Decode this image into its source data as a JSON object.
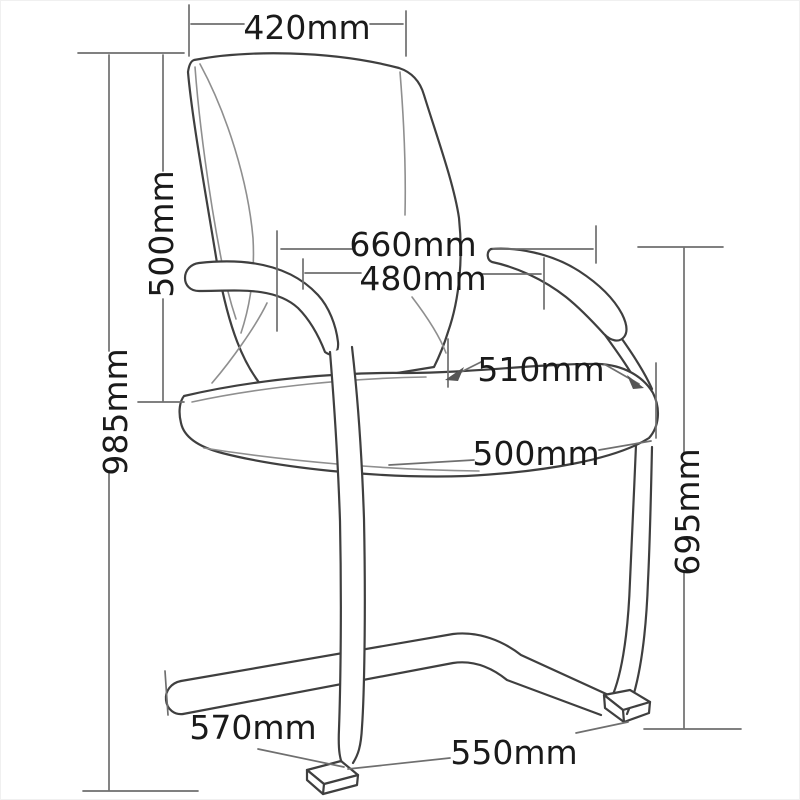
{
  "diagram": {
    "subject": "Cantilever visitor chair - dimensioned side view line drawing",
    "unit": "mm",
    "colors": {
      "background": "#ffffff",
      "chair_line": "#3f3f3f",
      "dimension_line": "#6f6f6f",
      "label_text": "#1a1a1a"
    },
    "dimensions": {
      "back_width": {
        "label": "420mm"
      },
      "back_height": {
        "label": "500mm"
      },
      "overall_height": {
        "label": "985mm"
      },
      "overall_width": {
        "label": "660mm"
      },
      "between_arms": {
        "label": "480mm"
      },
      "seat_width": {
        "label": "510mm"
      },
      "seat_depth": {
        "label": "500mm"
      },
      "arm_height": {
        "label": "695mm"
      },
      "base_front_depth": {
        "label": "570mm"
      },
      "base_depth": {
        "label": "550mm"
      }
    }
  }
}
